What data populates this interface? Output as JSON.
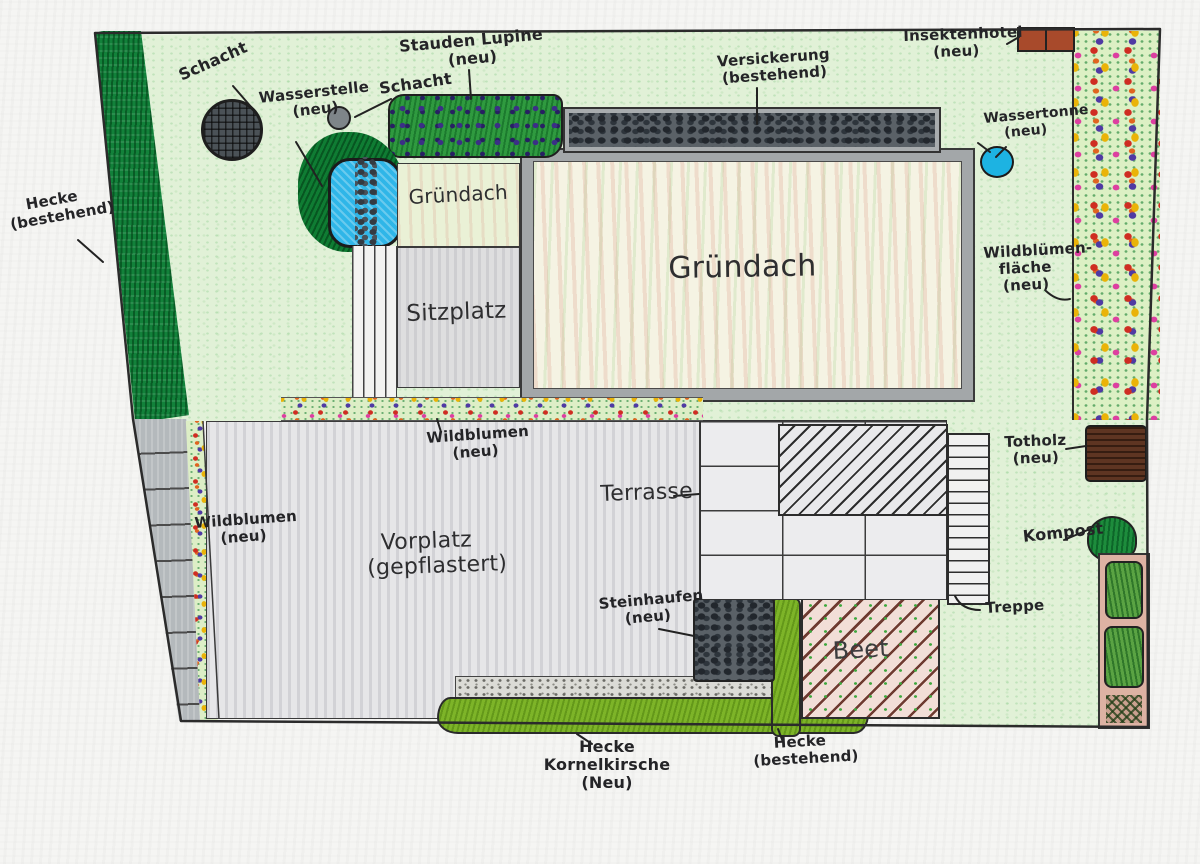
{
  "plan": {
    "title": "Handgezeichneter Gartenplan",
    "labels": {
      "schacht_top": "Schacht",
      "wasserstelle": "Wasserstelle\n(neu)",
      "schacht_small": "Schacht",
      "stauden_lupine": "Stauden Lupine\n(neu)",
      "versickerung": "Versickerung\n(bestehend)",
      "insektenhotel": "Insektenhotel\n(neu)",
      "wassertonne": "Wassertonne\n(neu)",
      "hecke_links": "Hecke\n(bestehend)",
      "gruendach_klein": "Gründach",
      "gruendach_gross": "Gründach",
      "sitzplatz": "Sitzplatz",
      "wildbluemenflaeche": "Wildblümen-\nfläche\n(neu)",
      "wildblumen_mitte": "Wildblumen\n(neu)",
      "totholz": "Totholz\n(neu)",
      "wildblumen_links": "Wildblumen\n(neu)",
      "vorplatz": "Vorplatz\n(gepflastert)",
      "terrasse": "Terrasse",
      "kompost": "Kompost",
      "steinhaufen": "Steinhaufen\n(neu)",
      "beet": "Beet",
      "treppe": "Treppe",
      "hecke_kornelkirsche": "Hecke Kornelkirsche\n(Neu)",
      "hecke_unten": "Hecke\n(bestehend)"
    },
    "colors": {
      "lawn": "#e1f1d7",
      "hedge_bestehend": "#12813a",
      "hedge_neu": "#7db428",
      "water": "#2fb6e8",
      "paving": "#e6e6e8",
      "gravel_dark": "#5a6167",
      "roof_frame": "#a3a7a9",
      "beet_soil": "#f2ded7",
      "totholz_wood": "#5e3522",
      "insektenhotel_brick": "#a84a2b"
    }
  }
}
